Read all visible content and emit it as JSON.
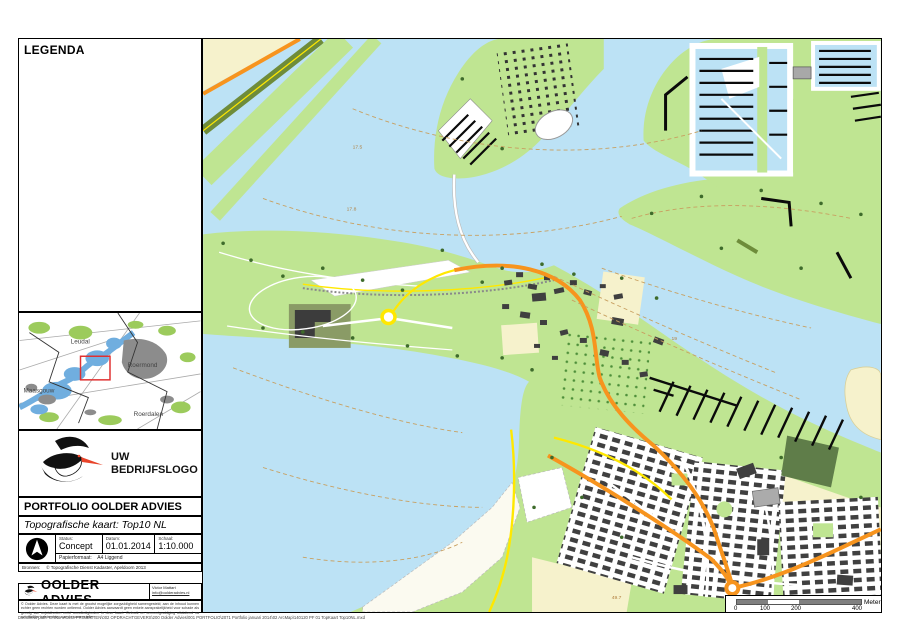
{
  "legend": {
    "title": "LEGENDA"
  },
  "overview_map": {
    "labels": {
      "leudal": "Leudal",
      "roermond": "Roermond",
      "maasgouw": "Maasgouw",
      "roerdalen": "Roerdalen"
    }
  },
  "logo": {
    "line1": "UW",
    "line2": "BEDRIJFSLOGO"
  },
  "title_block": {
    "title": "PORTFOLIO OOLDER ADVIES",
    "subtitle": "Topografische kaart: Top10 NL",
    "status_label": "Status:",
    "status_value": "Concept",
    "datum_label": "Datum:",
    "datum_value": "01.01.2014",
    "schaal_label": "Schaal:",
    "schaal_value": "1:10.000",
    "papierformaat_label": "Papierformaat:",
    "papierformaat_value": "A4 Liggend",
    "bronnen_label": "Bronnen:",
    "bronnen_value": "© Topografische Dienst Kadaster, Apeldoorn 2013"
  },
  "footer": {
    "company": "OOLDER ADVIES",
    "contact_name": "Victor Mattart",
    "contact_email": "info@oolderadvies.nl",
    "disclaimer": "© Oolder Advies. Deze kaart is met de grootst mogelijke zorgvuldigheid samengesteld; aan de inhoud kunnen echter geen rechten worden ontleend. Oolder Advies aanvaardt geen enkele aansprakelijkheid voor schade als gevolg van onjuistheden en/of onvolledigheden in deze kaart. Gebruik en vermenigvuldiging uitsluitend na schriftelijke toestemming van de samensteller."
  },
  "docpath": "Document path: G:\\01 AVOLIS PROJECTEN\\002 OPDRACHTGEVERS\\200 Oolder Advies\\001 PORTFOLIO\\2071 Portfolio januari 2014\\02 ArcMap\\140120 PF 01 TopKaart Top10NL.mxd",
  "scalebar": {
    "t0": "0",
    "t100": "100",
    "t200": "200",
    "t400": "400",
    "unit": "Meter"
  },
  "map": {
    "depth_labels": [
      {
        "text": "17.5"
      },
      {
        "text": "17.8"
      },
      {
        "text": "19"
      },
      {
        "text": "49.7"
      }
    ]
  },
  "colors": {
    "water": "#BCE2F5",
    "land_green": "#BFE592",
    "olive_band": "#6E8C3A",
    "forest_dark": "#5F7D49",
    "cream_field": "#F6F2CC",
    "orange_road": "#F7941E",
    "yellow_road": "#FFE800",
    "building": "#3F3F3F",
    "gray_building": "#ABABAB",
    "pier_black": "#0A0A0A",
    "contour_tan": "#C8A061",
    "minimap_water": "#70AEDF",
    "minimap_green": "#9CCB5C",
    "minimap_urban": "#8C8C8C",
    "extent_red": "#E03030",
    "logo_beak_red": "#E8442A",
    "scalebar_gray": "#808080"
  }
}
